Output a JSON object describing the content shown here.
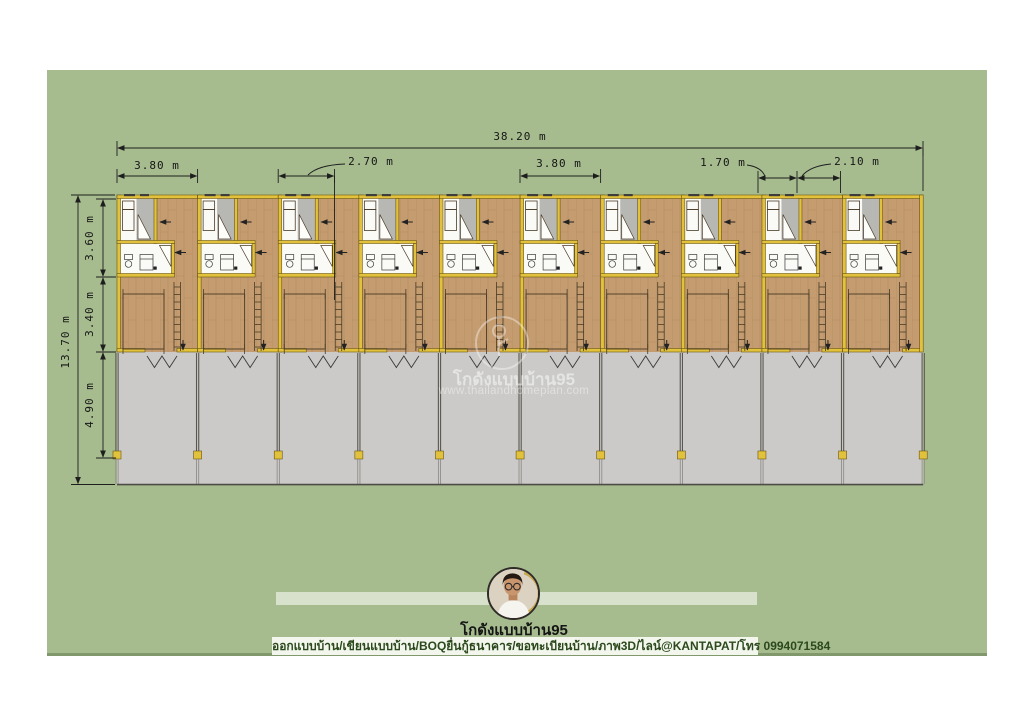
{
  "dimensions": {
    "overall_width": "38.20 m",
    "unit_width_left": "3.80 m",
    "interior_width": "2.70 m",
    "unit_width_mid": "3.80 m",
    "bay_width_left": "1.70 m",
    "bay_width_right": "2.10 m",
    "overall_depth": "13.70 m",
    "zone_depth_top": "3.60 m",
    "zone_depth_middle": "3.40 m",
    "zone_depth_bottom": "4.90 m"
  },
  "plan": {
    "unit_count": 10
  },
  "watermark": {
    "title": "โกดังแบบบ้าน95",
    "url": "www.thailandhomeplan.com"
  },
  "branding": {
    "name": "โกดังแบบบ้าน95",
    "caption": "ออกแบบบ้าน/เขียนแบบบ้าน/BOQยื่นกู้ธนาคาร/ขอทะเบียนบ้าน/ภาพ3D/ไลน์@KANTAPAT/โทร 0994071584"
  },
  "colors": {
    "canvas-green": "#a6bc8f",
    "wood-floor": "#c49c70",
    "wall-yellow": "#e2c23c",
    "concrete-gray": "#cbcac8",
    "tile-gray": "#b7b7b4",
    "caption-bg": "#f3f6ec",
    "caption-text": "#2b491d"
  }
}
